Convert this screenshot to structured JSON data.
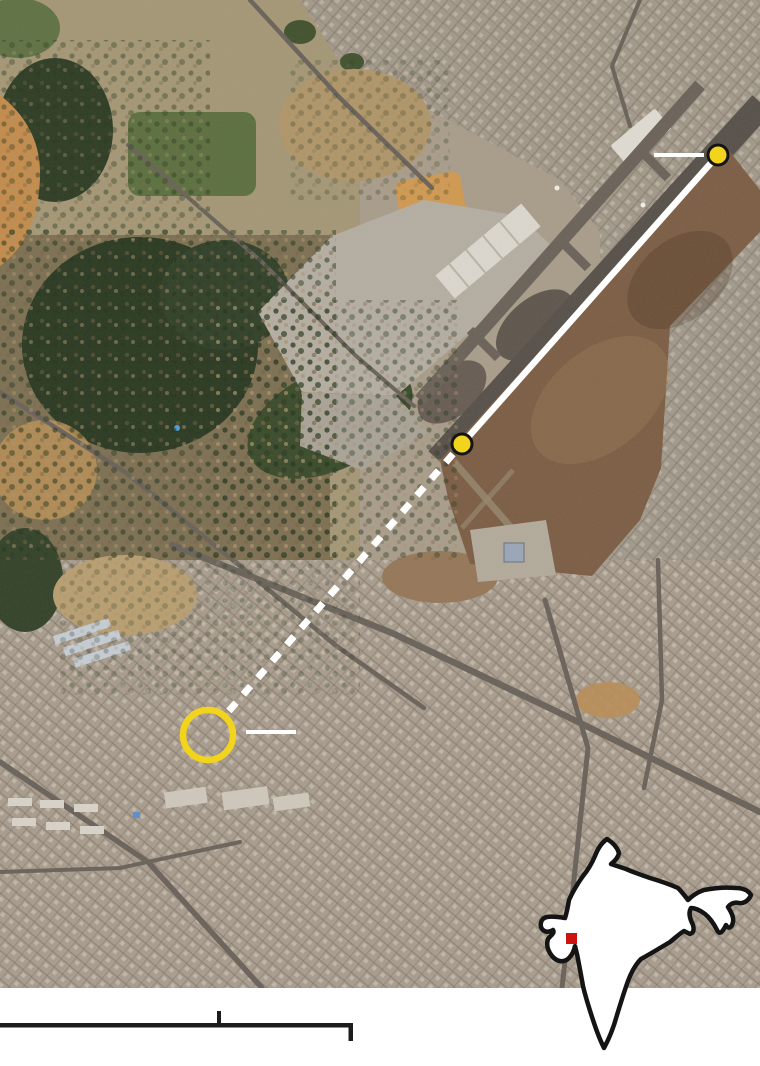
{
  "graphic": {
    "kind": "annotated-satellite-map",
    "colors": {
      "annotation_white": "#ffffff",
      "annotation_yellow": "#f3d41c",
      "outline_black": "#141414",
      "marker_red": "#cb1310",
      "scalebar_black": "#1c1c1c"
    },
    "annotations": {
      "runway_line": {
        "x1": 718,
        "y1": 155,
        "x2": 462,
        "y2": 444,
        "width": 6.5
      },
      "flight_path_dashed": {
        "x1": 453,
        "y1": 454,
        "x2": 228,
        "y2": 712,
        "width": 7,
        "dash": "11 11"
      },
      "dot_radius": 10,
      "dot_stroke_width": 3,
      "runway_dot_top": {
        "x": 718,
        "y": 155
      },
      "runway_dot_bottom": {
        "x": 462,
        "y": 444
      },
      "crash_site_ring": {
        "x": 208,
        "y": 735,
        "r": 25,
        "stroke_width": 6.5
      },
      "leader_top": {
        "x1": 654,
        "y1": 155,
        "x2": 704,
        "y2": 155,
        "width": 4
      },
      "leader_crash": {
        "x1": 246,
        "y1": 732,
        "x2": 296,
        "y2": 732,
        "width": 4
      }
    },
    "inset_map": {
      "country_shape": "india-outline",
      "marker": {
        "x": 28,
        "y": 107,
        "size": 11
      }
    },
    "scale_bar": {
      "bar_x": 0,
      "bar_y": 1023,
      "bar_length": 353,
      "bar_thickness": 4.5,
      "mid_tick_x": 217,
      "end_tick_x": 348
    }
  }
}
